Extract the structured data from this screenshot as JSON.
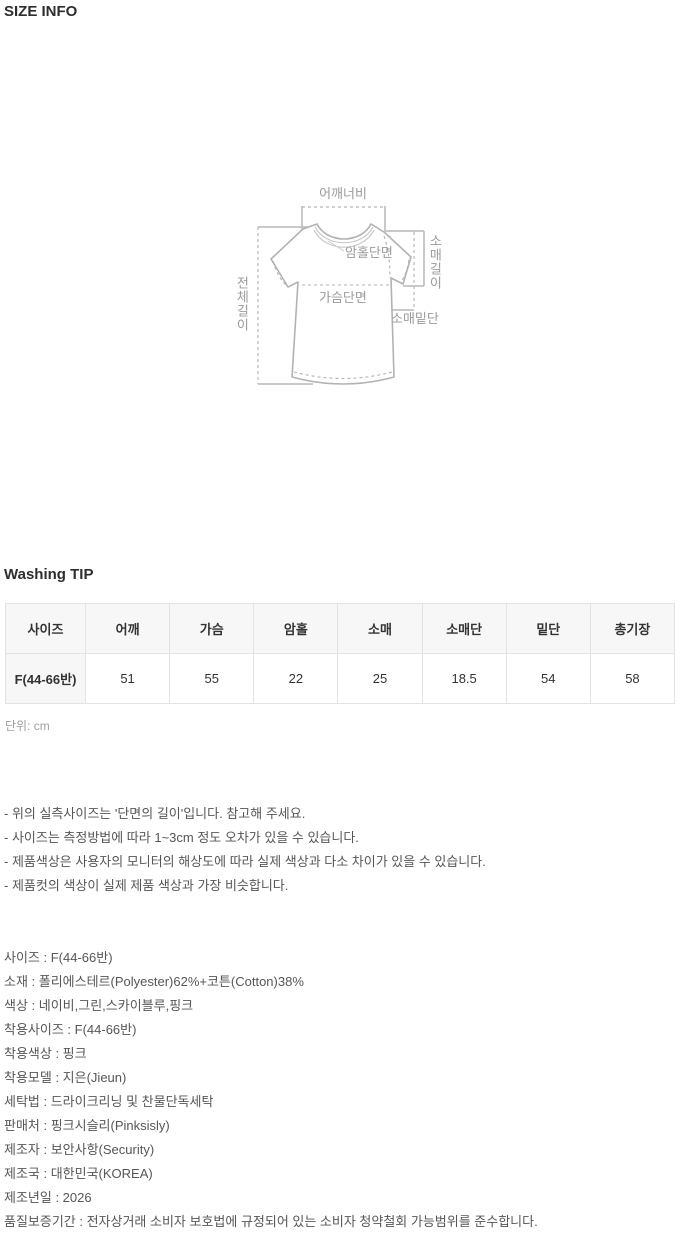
{
  "page": {
    "size_info_title": "SIZE INFO",
    "washing_tip_title": "Washing TIP",
    "unit_label": "단위: cm"
  },
  "diagram": {
    "labels": {
      "shoulder_width": "어깨너비",
      "armhole": "암홀단면",
      "chest": "가슴단면",
      "sleeve_length": "소매길이",
      "sleeve_hem": "소매밑단",
      "total_length": "전체길이"
    },
    "line_color": "#b5b5b5",
    "label_color": "#9b9b9b"
  },
  "size_table": {
    "headers": [
      "사이즈",
      "어깨",
      "가슴",
      "암홀",
      "소매",
      "소매단",
      "밑단",
      "총기장"
    ],
    "rows": [
      [
        "F(44-66반)",
        "51",
        "55",
        "22",
        "25",
        "18.5",
        "54",
        "58"
      ]
    ]
  },
  "notes": [
    "- 위의 실측사이즈는 '단면의 길이'입니다. 참고해 주세요.",
    "- 사이즈는 측정방법에 따라 1~3cm 정도 오차가 있을 수 있습니다.",
    "- 제품색상은 사용자의 모니터의 해상도에 따라 실제 색상과 다소 차이가 있을 수 있습니다.",
    "- 제품컷의 색상이 실제 제품 색상과 가장 비슷합니다."
  ],
  "product_details": [
    "사이즈 : F(44-66반)",
    "소재 : 폴리에스테르(Polyester)62%+코튼(Cotton)38%",
    "색상 : 네이비,그린,스카이블루,핑크",
    "착용사이즈 : F(44-66반)",
    "착용색상 : 핑크",
    "착용모델 : 지은(Jieun)",
    "세탁법 : 드라이크리닝 및 찬물단독세탁",
    "판매처 : 핑크시슬리(Pinksisly)",
    "제조자 : 보안사항(Security)",
    "제조국 : 대한민국(KOREA)",
    "제조년일 : 2026",
    "품질보증기간 : 전자상거래 소비자 보호법에 규정되어 있는 소비자 청약철회 가능범위를 준수합니다."
  ]
}
